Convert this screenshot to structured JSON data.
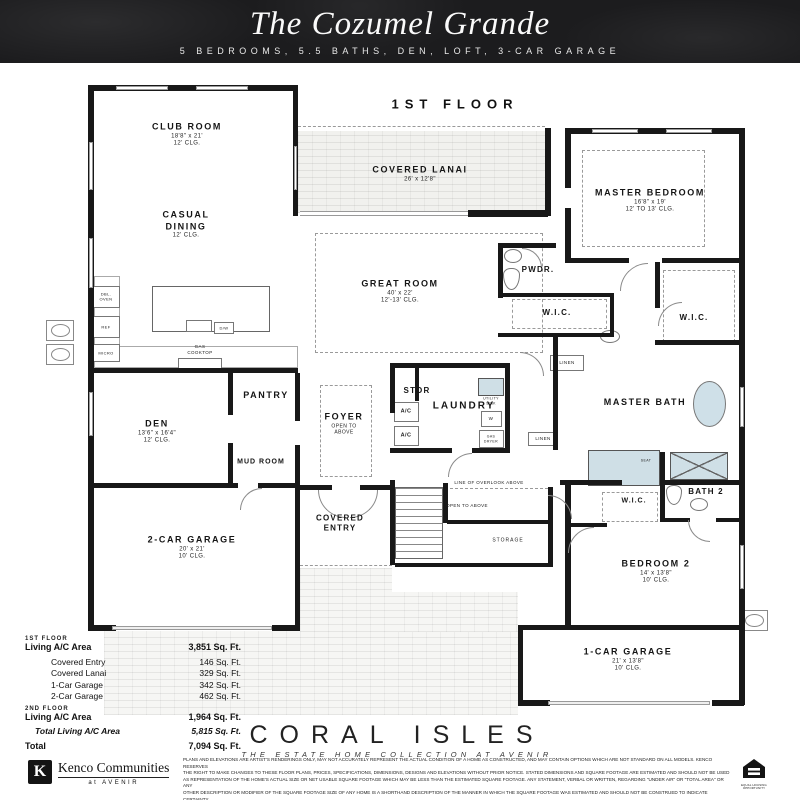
{
  "header": {
    "title": "The Cozumel Grande",
    "subtitle": "5 BEDROOMS, 5.5 BATHS, DEN, LOFT, 3-CAR GARAGE"
  },
  "plan": {
    "floor_label": "1ST FLOOR",
    "rooms": {
      "club_room": {
        "name": "CLUB ROOM",
        "dim": "18'8\" x 21'",
        "clg": "12' CLG."
      },
      "casual_dining": {
        "name": "CASUAL DINING",
        "clg": "12' CLG."
      },
      "covered_lanai": {
        "name": "COVERED LANAI",
        "dim": "26' x 12'8\""
      },
      "great_room": {
        "name": "GREAT ROOM",
        "dim": "40' x 22'",
        "clg": "12'-13' CLG."
      },
      "master_bedroom": {
        "name": "MASTER BEDROOM",
        "dim": "16'8\" x 19'",
        "clg": "12' TO 13' CLG."
      },
      "pwdr": {
        "name": "PWDR."
      },
      "wic": {
        "name": "W.I.C."
      },
      "master_bath": {
        "name": "MASTER BATH"
      },
      "bath_2": {
        "name": "BATH 2"
      },
      "bedroom_2": {
        "name": "BEDROOM 2",
        "dim": "14' x 13'8\"",
        "clg": "10' CLG."
      },
      "den": {
        "name": "DEN",
        "dim": "13'6\" x 16'4\"",
        "clg": "12' CLG."
      },
      "pantry": {
        "name": "PANTRY"
      },
      "mud_room": {
        "name": "MUD ROOM"
      },
      "foyer": {
        "name": "FOYER",
        "note": "OPEN TO ABOVE"
      },
      "stor": {
        "name": "STOR"
      },
      "laundry": {
        "name": "LAUNDRY"
      },
      "storage": {
        "name": "STORAGE"
      },
      "covered_entry": {
        "name": "COVERED ENTRY"
      },
      "garage_2car": {
        "name": "2-CAR GARAGE",
        "dim": "20' x 21'",
        "clg": "10' CLG."
      },
      "garage_1car": {
        "name": "1-CAR GARAGE",
        "dim": "21' x 13'8\"",
        "clg": "10' CLG."
      }
    },
    "annotations": {
      "open_to_above": "OPEN TO ABOVE",
      "line_of_overlook": "LINE OF OVERLOOK ABOVE",
      "linen": "LINEN",
      "seat": "SEAT"
    },
    "fixtures": {
      "dbl_oven": "DBL. OVEN",
      "ref": "REF",
      "micro": "MICRO",
      "gas_cooktop": "GAS COOKTOP",
      "dw": "D/W",
      "utility_sink": "UTILITY SINK",
      "washer": "W",
      "gas_dryer": "GAS DRYER",
      "ac": "A/C"
    }
  },
  "area_table": {
    "floor1_header": "1ST FLOOR",
    "floor2_header": "2ND FLOOR",
    "rows": [
      {
        "label": "Living A/C Area",
        "value": "3,851 Sq. Ft."
      },
      {
        "label": "Covered Entry",
        "value": "146 Sq. Ft."
      },
      {
        "label": "Covered Lanai",
        "value": "329 Sq. Ft."
      },
      {
        "label": "1-Car Garage",
        "value": "342 Sq. Ft."
      },
      {
        "label": "2-Car Garage",
        "value": "462 Sq. Ft."
      },
      {
        "label": "Living A/C Area",
        "value": "1,964 Sq. Ft."
      },
      {
        "label": "Total Living A/C Area",
        "value": "5,815 Sq. Ft."
      },
      {
        "label": "Total",
        "value": "7,094 Sq. Ft."
      }
    ]
  },
  "footer": {
    "brand": "CORAL ISLES",
    "tagline": "THE ESTATE HOME COLLECTION AT AVENIR",
    "builder_name": "Kenco Communities",
    "builder_sub": "at AVENIR",
    "builder_mark": "K",
    "equal_housing_label": "EQUAL HOUSING OPPORTUNITY",
    "disclaimer_lines": [
      "PLANS AND ELEVATIONS ARE ARTIST'S RENDERINGS ONLY, MAY NOT ACCURATELY REPRESENT THE ACTUAL CONDITION OF A HOME AS CONSTRUCTED, AND MAY CONTAIN OPTIONS WHICH ARE NOT STANDARD ON ALL MODELS. KENCO RESERVES",
      "THE RIGHT TO MAKE CHANGES TO THESE FLOOR PLANS, PRICES, SPECIFICATIONS, DIMENSIONS, DESIGNS AND ELEVATIONS WITHOUT PRIOR NOTICE. STATED DIMENSIONS AND SQUARE FOOTAGE ARE ESTIMATED AND SHOULD NOT BE USED",
      "AS REPRESENTATION OF THE HOME'S ACTUAL SIZE OR NET USABLE SQUARE FOOTAGE WHICH MAY BE LESS THAN THE ESTIMATED SQUARE FOOTAGE. ANY STATEMENT, VERBAL OR WRITTEN, REGARDING \"UNDER AIR\" OR \"TOTAL AREA\" OR ANY",
      "OTHER DESCRIPTION OR MODIFIER OF THE SQUARE FOOTAGE SIZE OF ANY HOME IS A SHORTHAND DESCRIPTION OF THE MANNER IN WHICH THE SQUARE FOOTAGE WAS ESTIMATED AND SHOULD NOT BE CONSTRUED TO INDICATE CERTAINTY.",
      "GARAGE OR BAY SIZES MAY VARY FROM HOME TO HOME AND MAY NOT ACCOMMODATE ALL VEHICLES. *LOT SIZES ARE APPROXIMATE AND REFER TO SALES ASSOCIATE FOR EXACT MEASUREMENTS."
    ]
  }
}
